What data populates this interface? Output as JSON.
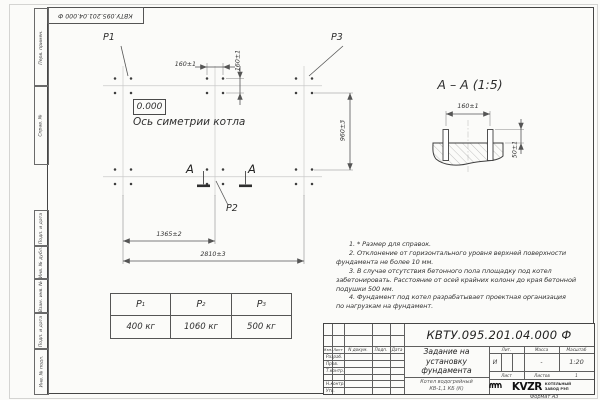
{
  "sheet": {
    "top_stamp": "КВТУ.095.201.04.000  Ф",
    "format_note": "Формат А3"
  },
  "margin_stamps": {
    "perv_primen": "Перв. примен.",
    "sprav_n": "Справ. №",
    "podp_data_1": "Подп. и дата",
    "inv_dubl": "Инв. № дубл.",
    "vzam_inv": "Взам. инв. №",
    "podp_data_2": "Подп. и дата",
    "inv_podl": "Инв. № подл."
  },
  "plan": {
    "p1": "P1",
    "p2": "P2",
    "p3": "P3",
    "elevation": "0.000",
    "axis_label": "Ось симетрии котла",
    "dim_160_h": "160±1",
    "dim_160_v": "160±1",
    "dim_960": "960±3",
    "dim_1365": "1365±2",
    "dim_2810": "2810±3",
    "cut_letter": "А"
  },
  "section": {
    "title": "А – А (1:5)",
    "dim_160": "160±1",
    "dim_50": "50±1"
  },
  "notes": {
    "lines": [
      "1. * Размер для справок.",
      "2. Отклонение от горизонтального уровня верхней поверхности",
      "фундамента не более 10 мм.",
      "3. В случае отсутствия бетонного пола площадку под котел",
      "забетонировать. Расстояние от осей крайних колонн до края бетонной",
      "подушки 500 мм.",
      "4. Фундамент под котел разрабатывает проектная организация",
      "по нагрузкам на фундамент."
    ]
  },
  "load_table": {
    "columns": [
      {
        "symbol": "P",
        "sub": "1",
        "value": "400 кг"
      },
      {
        "symbol": "P",
        "sub": "2",
        "value": "1060 кг"
      },
      {
        "symbol": "P",
        "sub": "3",
        "value": "500 кг"
      }
    ]
  },
  "title_block": {
    "designation": "КВТУ.095.201.04.000  Ф",
    "doc_title": [
      "Задание на",
      "установку",
      "фундамента"
    ],
    "product": [
      "Котел водогрейный",
      "КВ-1,1 КБ (К)"
    ],
    "cols": {
      "izm": "Изм.",
      "list": "Лист",
      "n_doc": "N докум.",
      "podp": "Подп.",
      "data": "Дата"
    },
    "rows": {
      "razrab": "Разраб.",
      "prov": "Пров.",
      "t_kontr": "Т.контр.",
      "n_kontr": "Н.контр.",
      "utv": "Утв."
    },
    "lit_label": "Лит.",
    "mass_label": "Масса",
    "scale_label": "Масштаб",
    "lit_value": "И",
    "mass_value": "-",
    "scale_value": "1:20",
    "sheet_label": "Лист",
    "sheets_label": "Листов",
    "sheets_value": "1",
    "logo_text": "KVZR",
    "logo_caption": [
      "КОТЕЛЬНЫЙ",
      "ЗАВОД РЭП"
    ]
  }
}
